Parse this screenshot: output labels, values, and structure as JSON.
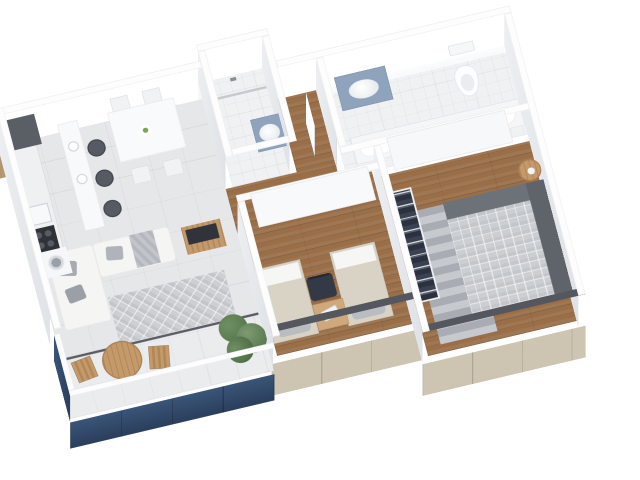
{
  "scene": {
    "type": "isometric 3D apartment floor plan render",
    "background": "#ffffff",
    "rooms": [
      {
        "name": "Kitchen",
        "floor": "light gray tile",
        "furniture": [
          "refrigerator",
          "sink",
          "cooktop",
          "washing machine",
          "breakfast bar",
          "bar stool",
          "bar stool",
          "bar stool"
        ]
      },
      {
        "name": "Dining area",
        "floor": "light gray tile",
        "furniture": [
          "dining table",
          "cross-back chair",
          "cross-back chair",
          "cross-back chair",
          "cross-back chair",
          "fruit plate"
        ]
      },
      {
        "name": "Living room",
        "floor": "light gray tile",
        "furniture": [
          "L-shaped sofa",
          "throw pillows",
          "throw blanket",
          "lattice rug",
          "wood media unit"
        ]
      },
      {
        "name": "Balcony",
        "floor": "pale tile",
        "furniture": [
          "round wooden table",
          "folding chair",
          "folding chair",
          "green shrub",
          "navy glass railing"
        ]
      },
      {
        "name": "Bathroom",
        "floor": "white tile",
        "furniture": [
          "walk-in shower",
          "glass screen",
          "blue-top vanity sink"
        ]
      },
      {
        "name": "En-suite bathroom",
        "floor": "white tile",
        "furniture": [
          "blue-top vanity with wood cabinet",
          "toilet",
          "bathtub"
        ]
      },
      {
        "name": "Hallway",
        "floor": "wood plank",
        "furniture": [
          "open white door",
          "open white door"
        ]
      },
      {
        "name": "Bedroom",
        "floor": "wood plank",
        "furniture": [
          "wardrobe with hanging clothes",
          "twin bed",
          "twin bed",
          "desk",
          "laptop",
          "navy desk chair"
        ]
      },
      {
        "name": "Master bedroom",
        "floor": "wood plank",
        "furniture": [
          "panel wardrobe",
          "open wardrobe with clothes",
          "double bed with plaid duvet",
          "striped gray rug",
          "round side table"
        ]
      }
    ],
    "colors": {
      "wood_wall": "#b2956f",
      "wood_floor": "#9a6f48",
      "tile": "#e6e7e9",
      "tile2": "#ebecee",
      "bath_tile": "#f0f1f3",
      "beige": "#cdc4b2",
      "dark_top": "#54575d",
      "navy1": "#3a5578",
      "navy2": "#2a3e5c",
      "counter_blue": "#8fa3bc",
      "sofa": "#f5f5f3",
      "rug": "#cdd0d3",
      "plaid": "#cbcfd3",
      "wood_furniture": "#c49a6a",
      "chair_navy": "#333a46",
      "stool": "#565b63",
      "plant_light": "#6f8f63",
      "plant_dark": "#4f6e47"
    }
  }
}
